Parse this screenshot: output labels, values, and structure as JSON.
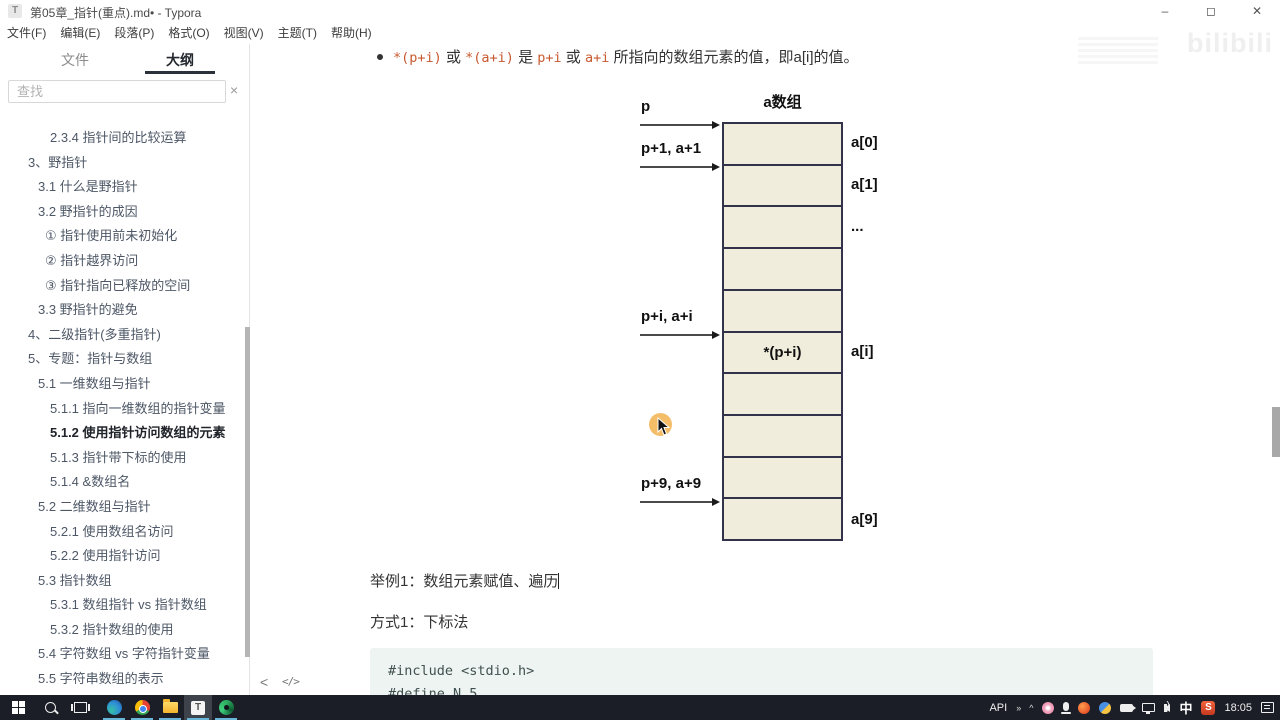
{
  "window": {
    "title": "第05章_指针(重点).md• - Typora",
    "app_icon_letter": "T",
    "controls": {
      "minimize": "–",
      "maximize": "◻",
      "close": "✕"
    }
  },
  "menu": {
    "items": [
      "文件(F)",
      "编辑(E)",
      "段落(P)",
      "格式(O)",
      "视图(V)",
      "主题(T)",
      "帮助(H)"
    ]
  },
  "sidebar": {
    "tabs": {
      "files": "文件",
      "outline": "大纲"
    },
    "search": {
      "placeholder": "查找",
      "close_label": "×"
    },
    "outline": [
      {
        "text": "2.3.4 指针间的比较运算",
        "level": 3,
        "active": false
      },
      {
        "text": "3、野指针",
        "level": 1,
        "active": false
      },
      {
        "text": "3.1 什么是野指针",
        "level": 2,
        "active": false
      },
      {
        "text": "3.2 野指针的成因",
        "level": 2,
        "active": false
      },
      {
        "text": "① 指针使用前未初始化",
        "level": 4,
        "active": false
      },
      {
        "text": "② 指针越界访问",
        "level": 4,
        "active": false
      },
      {
        "text": "③ 指针指向已释放的空间",
        "level": 4,
        "active": false
      },
      {
        "text": "3.3 野指针的避免",
        "level": 2,
        "active": false
      },
      {
        "text": "4、二级指针(多重指针)",
        "level": 1,
        "active": false
      },
      {
        "text": "5、专题：指针与数组",
        "level": 1,
        "active": false
      },
      {
        "text": "5.1 一维数组与指针",
        "level": 2,
        "active": false
      },
      {
        "text": "5.1.1 指向一维数组的指针变量",
        "level": 3,
        "active": false
      },
      {
        "text": "5.1.2 使用指针访问数组的元素",
        "level": 3,
        "active": true
      },
      {
        "text": "5.1.3 指针带下标的使用",
        "level": 3,
        "active": false
      },
      {
        "text": "5.1.4 &数组名",
        "level": 3,
        "active": false
      },
      {
        "text": "5.2 二维数组与指针",
        "level": 2,
        "active": false
      },
      {
        "text": "5.2.1 使用数组名访问",
        "level": 3,
        "active": false
      },
      {
        "text": "5.2.2 使用指针访问",
        "level": 3,
        "active": false
      },
      {
        "text": "5.3 指针数组",
        "level": 2,
        "active": false
      },
      {
        "text": "5.3.1 数组指针 vs 指针数组",
        "level": 3,
        "active": false
      },
      {
        "text": "5.3.2 指针数组的使用",
        "level": 3,
        "active": false
      },
      {
        "text": "5.4 字符数组 vs 字符指针变量",
        "level": 2,
        "active": false
      },
      {
        "text": "5.5 字符串数组的表示",
        "level": 2,
        "active": false
      }
    ]
  },
  "content": {
    "bullet_segments": [
      {
        "text": "*(p+i)",
        "code": true
      },
      {
        "text": " 或 ",
        "code": false
      },
      {
        "text": "*(a+i)",
        "code": true
      },
      {
        "text": " 是 ",
        "code": false
      },
      {
        "text": "p+i",
        "code": true
      },
      {
        "text": " 或 ",
        "code": false
      },
      {
        "text": "a+i",
        "code": true
      },
      {
        "text": " 所指向的数组元素的值，即a[i]的值。",
        "code": false
      }
    ],
    "diagram": {
      "title": "a数组",
      "num_cells": 10,
      "cell_texts": [
        {
          "index": 5,
          "text": "*(p+i)"
        }
      ],
      "right_labels": [
        {
          "cell": 0,
          "text": "a[0]"
        },
        {
          "cell": 1,
          "text": "a[1]"
        },
        {
          "cell": 2,
          "text": "..."
        },
        {
          "cell": 5,
          "text": "a[i]"
        },
        {
          "cell": 9,
          "text": "a[9]"
        }
      ],
      "pointers": [
        {
          "boundary": 0,
          "label": "p"
        },
        {
          "boundary": 1,
          "label": "p+1, a+1"
        },
        {
          "boundary": 5,
          "label": "p+i, a+i"
        },
        {
          "boundary": 9,
          "label": "p+9, a+9"
        }
      ]
    },
    "example_line": "举例1：数组元素赋值、遍历",
    "method_line": "方式1：下标法",
    "code_block": {
      "lines": [
        "#include <stdio.h>",
        "#define N 5"
      ]
    },
    "footer": {
      "collapse": "<",
      "source_mode": "</>"
    },
    "watermark": "bilibili"
  },
  "taskbar": {
    "typora_letter": "T",
    "sogou_letter": "S",
    "tray": {
      "api_label": "API",
      "expand_chevrons": "»",
      "hidden_icons": "^",
      "ime": "中",
      "time": "18:05"
    }
  }
}
